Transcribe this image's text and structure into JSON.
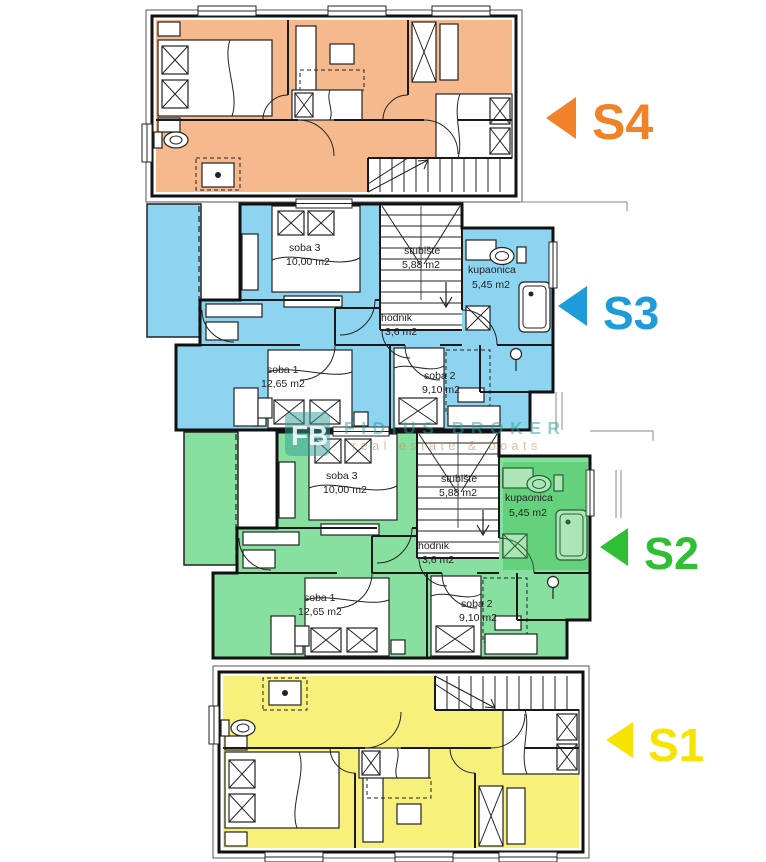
{
  "units": [
    {
      "id": "s4",
      "label": "S4",
      "color": "#F08329",
      "fill": "#F6B98E"
    },
    {
      "id": "s3",
      "label": "S3",
      "color": "#1E9CD9",
      "fill": "#8DD4F1"
    },
    {
      "id": "s2",
      "label": "S2",
      "color": "#2EBF35",
      "fill": "#87E0A0"
    },
    {
      "id": "s1",
      "label": "S1",
      "color": "#F6E400",
      "fill": "#F7F17B"
    }
  ],
  "rooms": {
    "s3": [
      {
        "name": "soba 3",
        "area": "10,00 m2"
      },
      {
        "name": "stubište",
        "area": "5,88 m2"
      },
      {
        "name": "kupaonica",
        "area": "5,45 m2"
      },
      {
        "name": "hodnik",
        "area": "3,6 m2"
      },
      {
        "name": "soba 1",
        "area": "12,65 m2"
      },
      {
        "name": "soba 2",
        "area": "9,10 m2"
      }
    ],
    "s2": [
      {
        "name": "soba 3",
        "area": "10,00 m2"
      },
      {
        "name": "stubište",
        "area": "5,88 m2"
      },
      {
        "name": "kupaonica",
        "area": "5,45 m2"
      },
      {
        "name": "hodnik",
        "area": "3,6 m2"
      },
      {
        "name": "soba 1",
        "area": "12,65 m2"
      },
      {
        "name": "soba 2",
        "area": "9,10 m2"
      }
    ]
  },
  "watermark": {
    "logo_text": "FB",
    "title": "FIDIUS BROKER",
    "tagline": "real estate & boats"
  }
}
